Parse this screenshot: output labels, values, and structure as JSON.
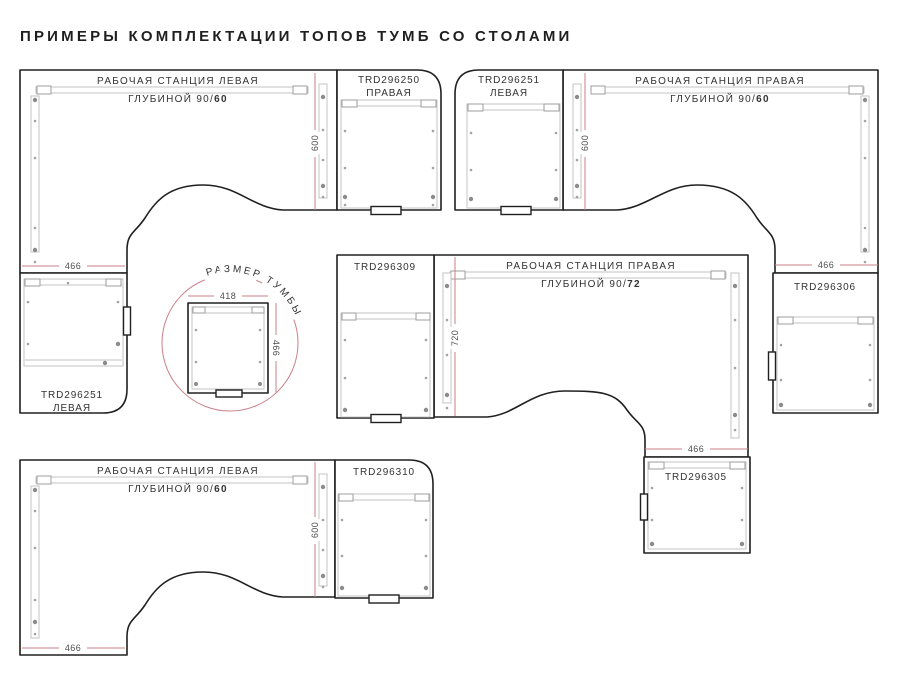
{
  "title": "ПРИМЕРЫ КОМПЛЕКТАЦИИ ТОПОВ ТУМБ СО СТОЛАМИ",
  "colors": {
    "accent_pink": "#c9808a",
    "outline": "#202020",
    "detail_gray": "#c3c3c3"
  },
  "d1": {
    "station1": "РАБОЧАЯ СТАНЦИЯ ЛЕВАЯ",
    "depth_prefix": "ГЛУБИНОЙ 90/",
    "depth_bold": "60",
    "cab_top_code": "TRD296250",
    "cab_top_side": "ПРАВАЯ",
    "cab_bottom_code": "TRD296251",
    "cab_bottom_side": "ЛЕВАЯ",
    "dim_v": "600",
    "dim_h": "466"
  },
  "d2": {
    "station1": "РАБОЧАЯ СТАНЦИЯ ПРАВАЯ",
    "depth_prefix": "ГЛУБИНОЙ 90/",
    "depth_bold": "60",
    "cab_left_code": "TRD296251",
    "cab_left_side": "ЛЕВАЯ",
    "cab_bottom_code": "TRD296306",
    "dim_v": "600",
    "dim_h": "466"
  },
  "d3": {
    "station1": "РАБОЧАЯ СТАНЦИЯ ПРАВАЯ",
    "depth_prefix": "ГЛУБИНОЙ 90/",
    "depth_bold": "72",
    "cab_left_code": "TRD296309",
    "cab_bottom_code": "TRD296305",
    "dim_v": "720",
    "dim_h": "466"
  },
  "d4": {
    "station1": "РАБОЧАЯ СТАНЦИЯ ЛЕВАЯ",
    "depth_prefix": "ГЛУБИНОЙ 90/",
    "depth_bold": "60",
    "cab_code": "TRD296310",
    "dim_v": "600",
    "dim_h": "466"
  },
  "size_circle": {
    "label": "РАЗМЕР ТУМБЫ",
    "dim_w": "418",
    "dim_h": "466"
  }
}
